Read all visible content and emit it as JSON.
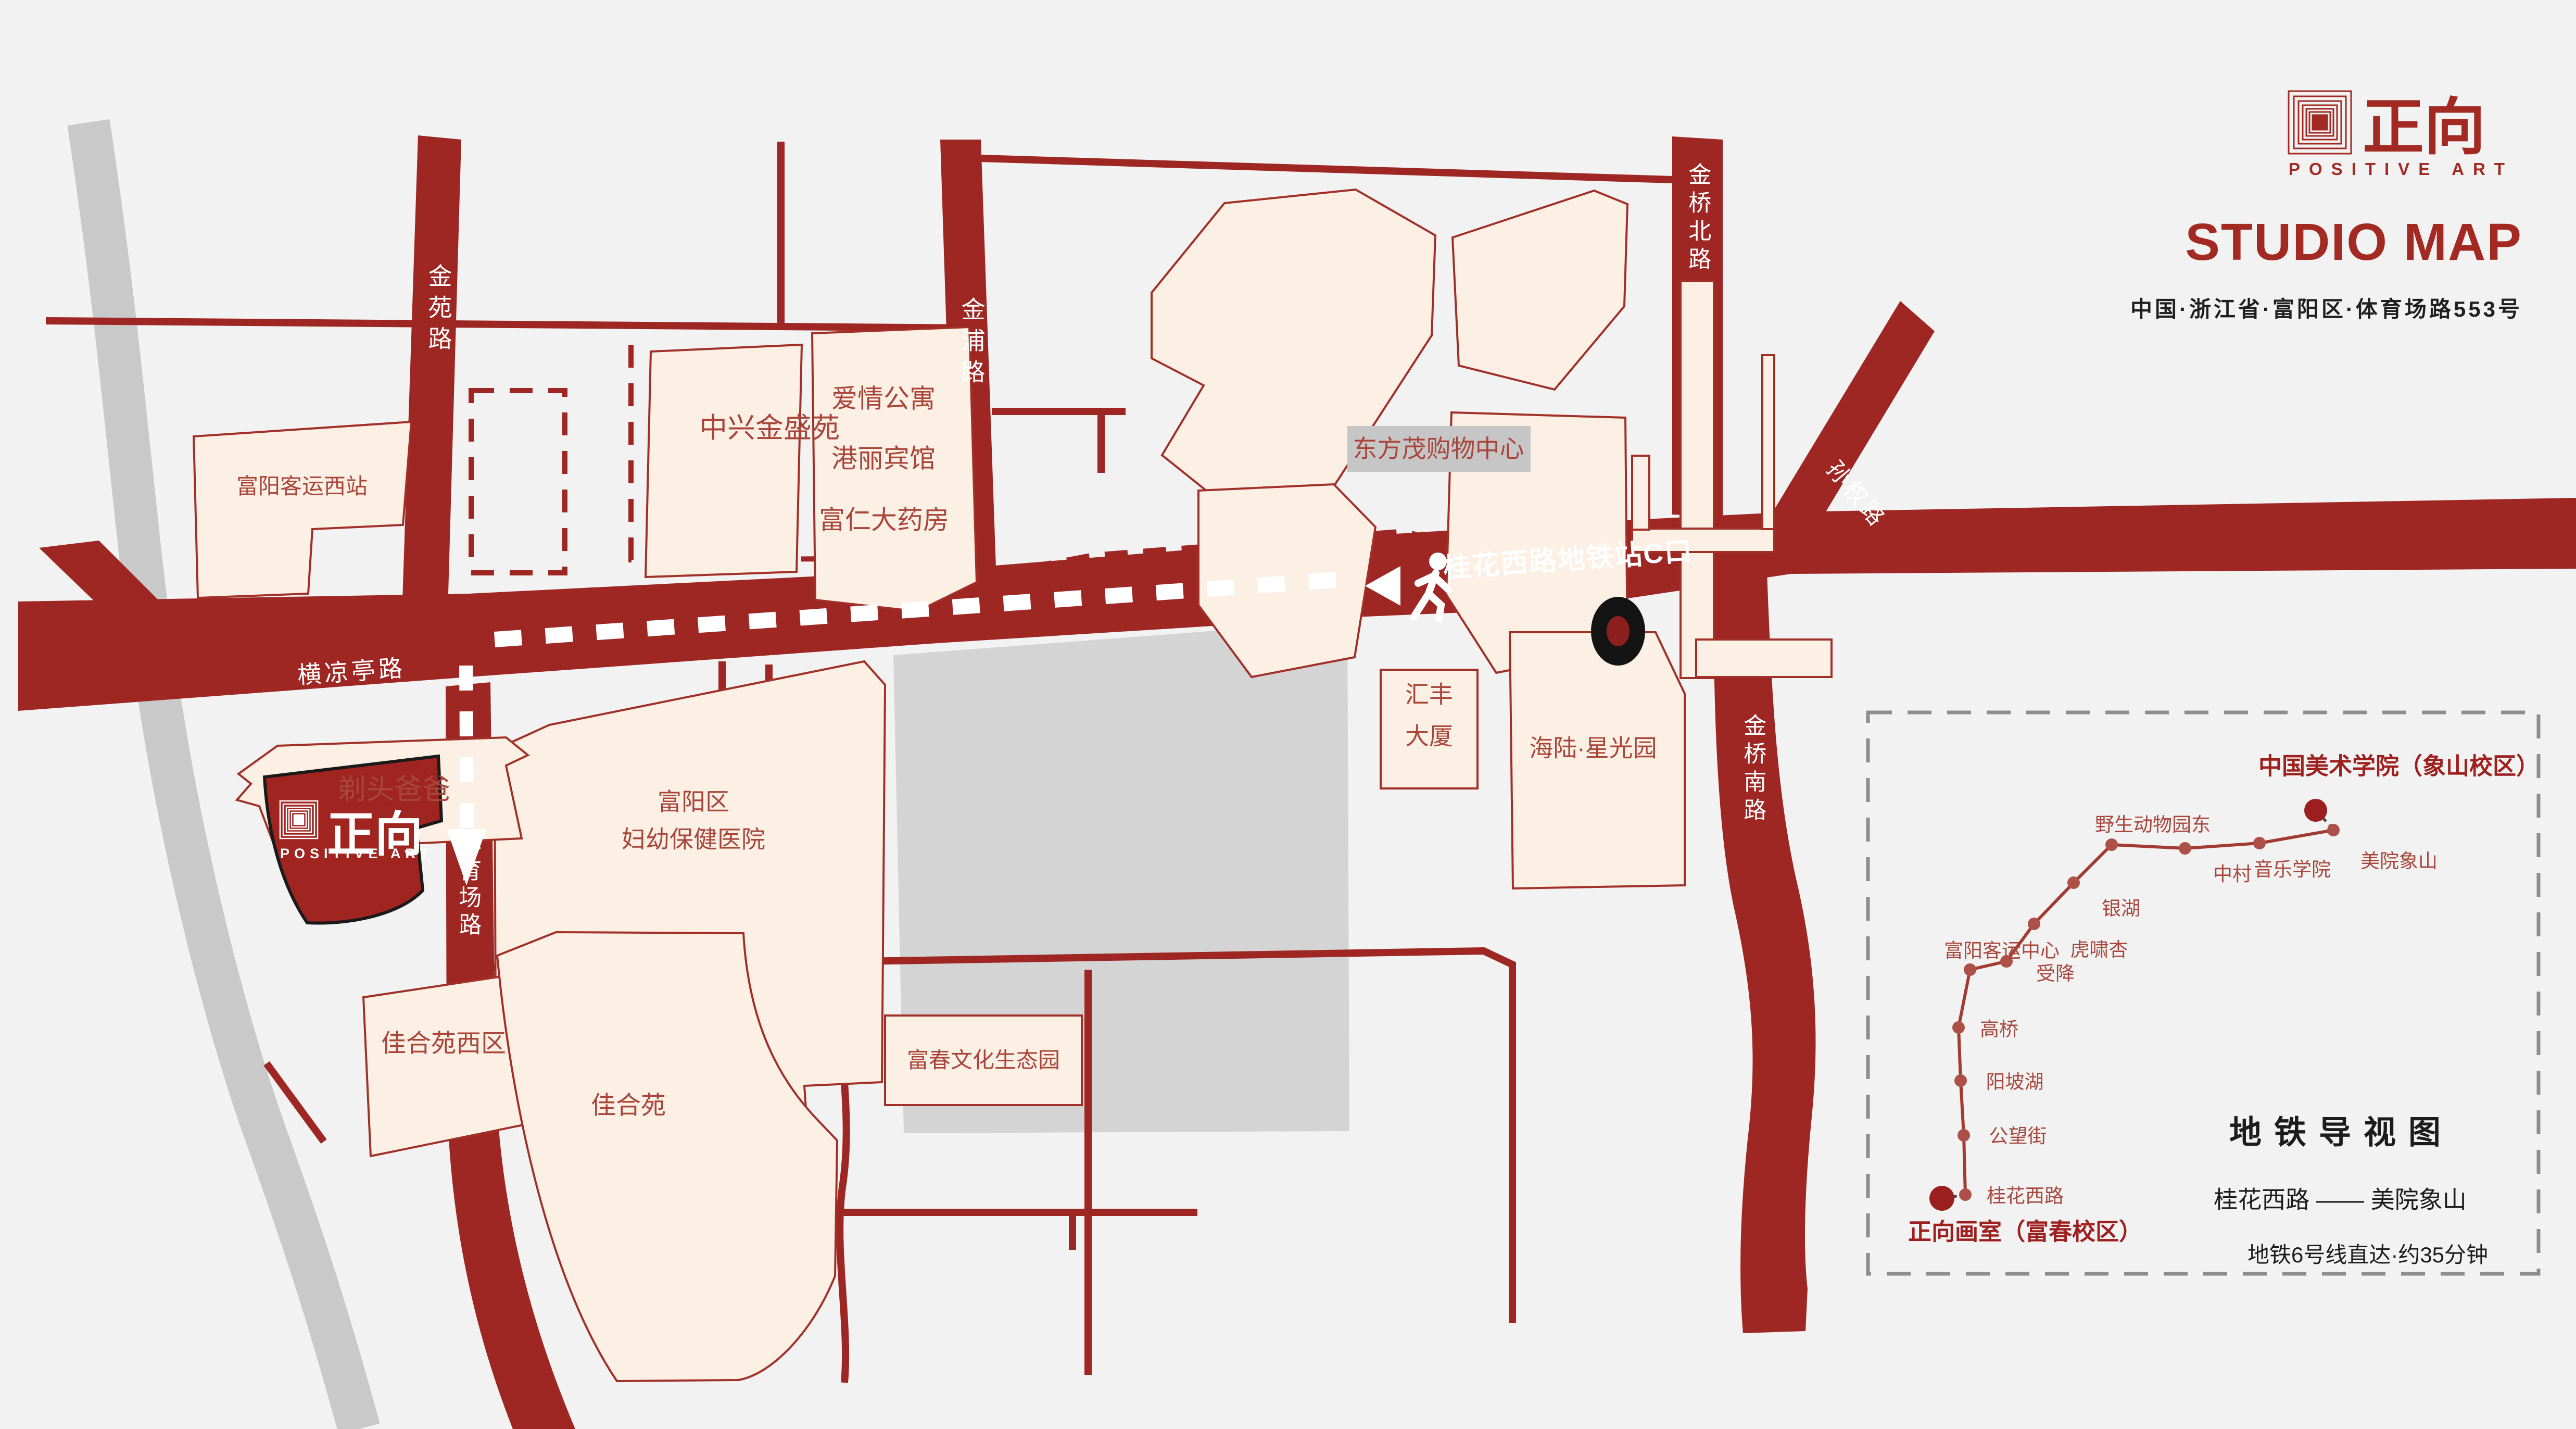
{
  "header": {
    "brand_cn": "正向",
    "brand_en": "POSITIVE ART",
    "title": "STUDIO MAP",
    "address": "中国·浙江省·富阳区·体育场路553号"
  },
  "roads": {
    "jinyuan": "金苑路",
    "jinpu": "金浦路",
    "jinqiao_north": "金桥北路",
    "jinqiao_south": "金桥南路",
    "sunquan": "孙权路",
    "hengliangting": "横凉亭路",
    "tiyuchang": "体育场路",
    "metro_exit": "桂花西路地铁站C口"
  },
  "places": {
    "west_bus_station": "富阳客运西站",
    "zhongxing": "中兴金盛苑",
    "apartment": "爱情公寓",
    "hotel": "港丽宾馆",
    "pharmacy": "富仁大药房",
    "dongfangmao": "东方茂购物中心",
    "huifeng_l1": "汇丰",
    "huifeng_l2": "大厦",
    "hailu": "海陆·星光园",
    "barber": "剃头爸爸",
    "hospital_l1": "富阳区",
    "hospital_l2": "妇幼保健医院",
    "jiaheyuan_west": "佳合苑西区",
    "jiaheyuan": "佳合苑",
    "eco_park": "富春文化生态园"
  },
  "studio_marker": {
    "brand_cn": "正向",
    "brand_en": "POSITIVE ART"
  },
  "inset": {
    "title": "地铁导视图",
    "route": "桂花西路 —— 美院象山",
    "note": "地铁6号线直达·约35分钟",
    "endpoint_top": "中国美术学院（象山校区）",
    "endpoint_bottom": "正向画室（富春校区）",
    "stations": [
      {
        "label": "桂花西路"
      },
      {
        "label": "公望街"
      },
      {
        "label": "阳坡湖"
      },
      {
        "label": "高桥"
      },
      {
        "label": "富阳客运中心"
      },
      {
        "label": "受降"
      },
      {
        "label": "虎啸杏"
      },
      {
        "label": "银湖"
      },
      {
        "label": "野生动物园东"
      },
      {
        "label": "中村"
      },
      {
        "label": "音乐学院"
      },
      {
        "label": "美院象山"
      }
    ]
  },
  "colors": {
    "background": "#f2f2f2",
    "road_red": "#9e2723",
    "building_fill": "#fcefe4",
    "building_stroke": "#a03028",
    "studio_fill": "#a02420",
    "gray_road": "#c9c9c9",
    "label_red": "#a8463c",
    "brand_red": "#a32a23"
  }
}
